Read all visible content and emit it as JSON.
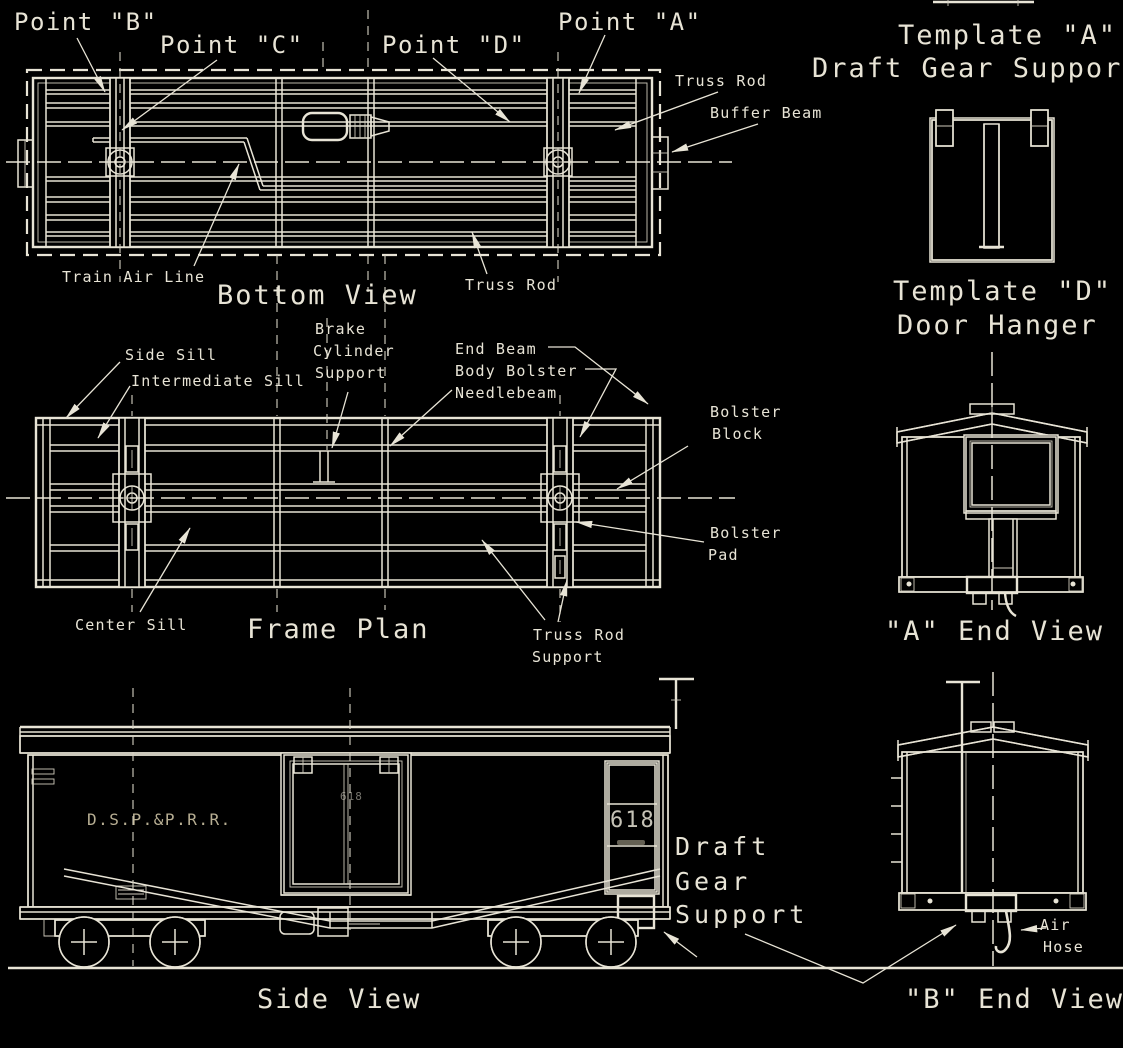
{
  "colors": {
    "background": "#000000",
    "line": "#e8e4d6",
    "lettering": "#d8cdad"
  },
  "callouts": {
    "point_b": "Point \"B\"",
    "point_c": "Point \"C\"",
    "point_d": "Point \"D\"",
    "point_a": "Point \"A\"",
    "truss_rod_upper": "Truss Rod",
    "buffer_beam": "Buffer Beam",
    "train_air_line": "Train Air Line",
    "truss_rod_lower": "Truss Rod",
    "side_sill": "Side Sill",
    "intermediate_sill": "Intermediate Sill",
    "brake_cylinder_support_line1": "Brake",
    "brake_cylinder_support_line2": "Cylinder",
    "brake_cylinder_support_line3": "Support",
    "end_beam": "End Beam",
    "body_bolster": "Body Bolster",
    "needlebeam": "Needlebeam",
    "bolster_block_line1": "Bolster",
    "bolster_block_line2": "Block",
    "bolster_pad_line1": "Bolster",
    "bolster_pad_line2": "Pad",
    "center_sill": "Center Sill",
    "truss_rod_support_line1": "Truss Rod",
    "truss_rod_support_line2": "Support",
    "draft_gear_support_line1": "Draft",
    "draft_gear_support_line2": "Gear",
    "draft_gear_support_line3": "Support",
    "air_hose_line1": "Air",
    "air_hose_line2": "Hose"
  },
  "captions": {
    "bottom_view": "Bottom View",
    "frame_plan": "Frame Plan",
    "side_view": "Side View",
    "a_end_view": "\"A\" End View",
    "b_end_view": "\"B\" End View"
  },
  "templates": {
    "template_a_title": "Template \"A\"",
    "template_a_subtitle": "Draft Gear Support",
    "template_d_title": "Template \"D\"",
    "template_d_subtitle": "Door Hanger"
  },
  "car": {
    "reporting_marks": "D.S.P.&P.R.R.",
    "door_number": "618",
    "end_number": "618"
  }
}
